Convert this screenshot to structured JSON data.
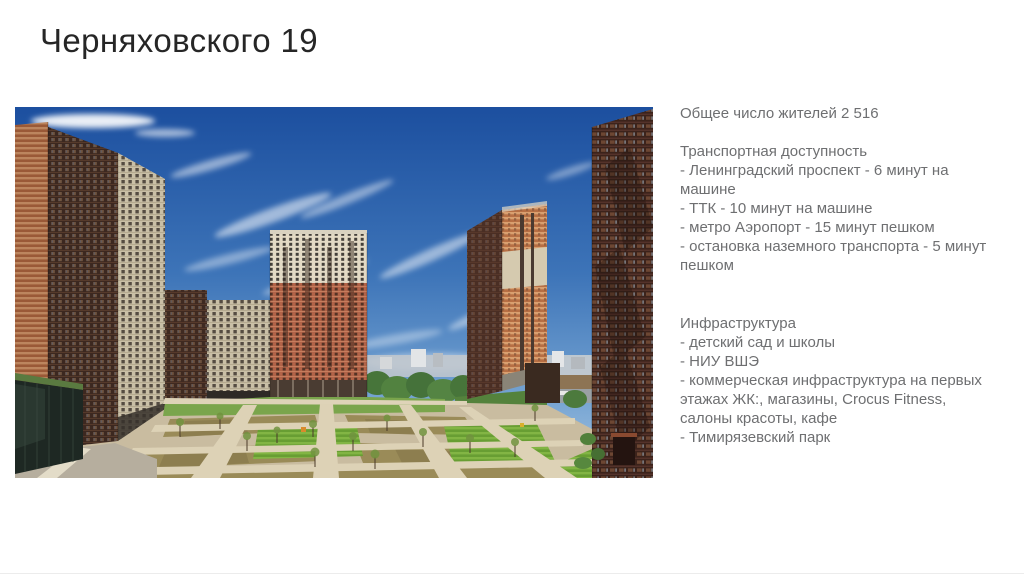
{
  "slide": {
    "title": "Черняховского 19"
  },
  "photo": {
    "description": "residential-complex-courtyard-photo"
  },
  "info_panel": {
    "residents_line": "Общее число жителей 2 516",
    "transport": {
      "heading": "Транспортная доступность",
      "items": [
        "- Ленинградский проспект - 6 минут на машине",
        "- ТТК - 10 минут на машине",
        "- метро Аэропорт - 15 минут пешком",
        "- остановка наземного транспорта - 5 минут пешком"
      ]
    },
    "infrastructure": {
      "heading": "Инфраструктура",
      "items": [
        "- детский сад и школы",
        "- НИУ ВШЭ",
        "- коммерческая инфраструктура на первых этажах ЖК:, магазины, Crocus Fitness, салоны красоты, кафе",
        "- Тимирязевский парк"
      ]
    }
  },
  "colors": {
    "background": "#ffffff",
    "title_text": "#262626",
    "body_text": "#6e6f71",
    "sky_top": "#1c4f9f",
    "sky_horizon": "#a9c6e2",
    "brick_light": "#c98a5f",
    "brick_dark": "#a85f3a",
    "building_shadow": "#3c2820",
    "building_cream": "#cfc4ab",
    "lawn_green": "#76a148",
    "path_beige": "#d3c7ad"
  }
}
